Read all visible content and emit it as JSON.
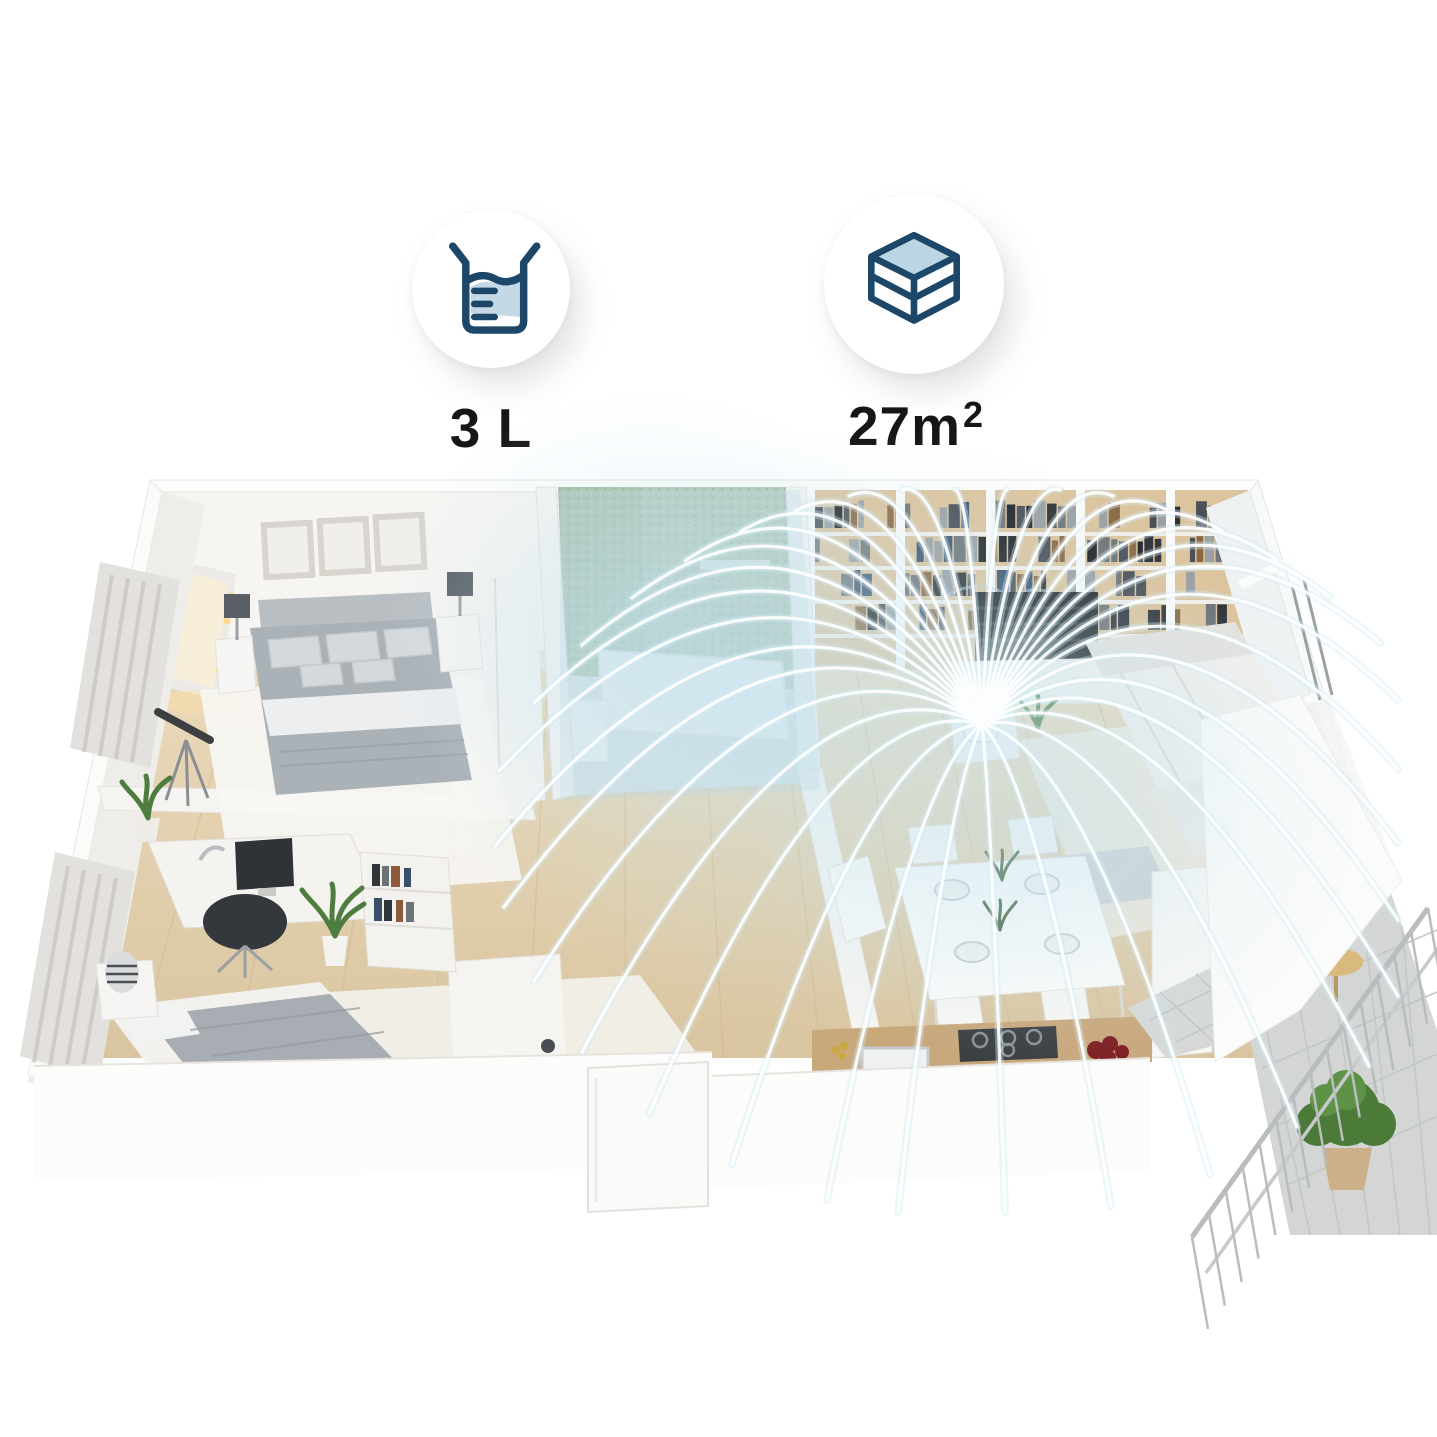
{
  "page": {
    "background": "#ffffff",
    "description": "3D cutaway apartment render showing humidifier mist coverage"
  },
  "specs": [
    {
      "id": "tank",
      "icon": "water-tank-icon",
      "label": "3 L"
    },
    {
      "id": "area",
      "icon": "coverage-area-icon",
      "label": "27m",
      "sup": "2"
    }
  ],
  "colors": {
    "icon_navy": "#1d4768",
    "icon_water_blue": "#b9d2e2",
    "label_black": "#161616",
    "mist_white": "#ffffff",
    "mist_glow": "#cdeaf3",
    "floor_wood": "#e2d0ae",
    "wall_white": "#f6f5f2",
    "bathroom_tile_green": "#aabfa8",
    "balcony_tile_gray": "#d3d6d5"
  }
}
